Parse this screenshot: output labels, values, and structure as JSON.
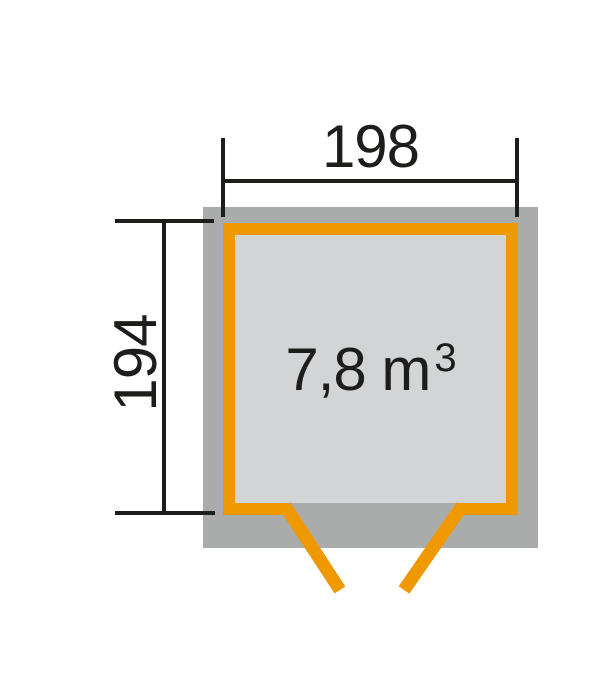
{
  "diagram": {
    "type": "shed-floor-plan",
    "width_dimension": "198",
    "depth_dimension": "194",
    "volume_value": "7,8 m",
    "volume_superscript": "3",
    "colors": {
      "accent": "#f09800",
      "footprint": "#aaabab",
      "interior": "#d2d4d5",
      "line": "#1d1d1b"
    }
  }
}
